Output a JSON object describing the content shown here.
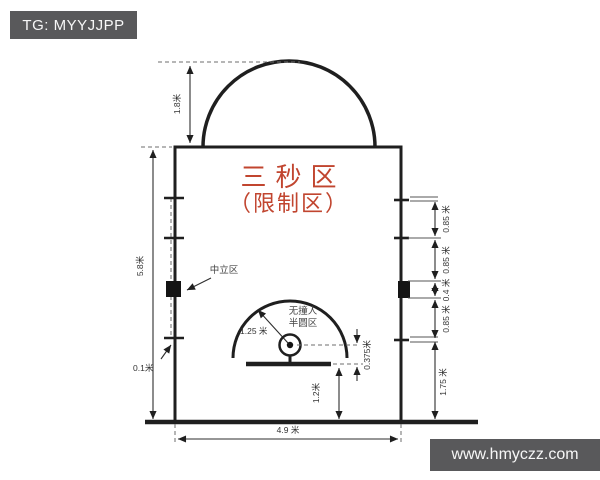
{
  "colors": {
    "badge_bg": "#59595b",
    "badge_text": "#f7f7f7",
    "accent_red": "#c1452f",
    "line": "#1f1f1f"
  },
  "header": {
    "badge": "TG: MYYJJPP"
  },
  "watermark": {
    "url_text": "www.hmyczz.com"
  },
  "diagram": {
    "title": {
      "line1": "三秒区",
      "line2": "（限制区）"
    },
    "zones": {
      "neutral": "中立区",
      "no_charge_line1": "无撞人",
      "no_charge_line2": "半圆区"
    },
    "dims": {
      "arc_height": "1.8米",
      "lane_length": "5.8米",
      "line_width": "0.1米",
      "lane_width": "4.9 米",
      "board_to_endline": "1.2米",
      "rim_to_board": "0.375米",
      "no_charge_radius": "1.25 米",
      "marks": [
        "0.85 米",
        "0.85 米",
        "0.4 米",
        "0.85 米",
        "1.75 米"
      ]
    }
  }
}
